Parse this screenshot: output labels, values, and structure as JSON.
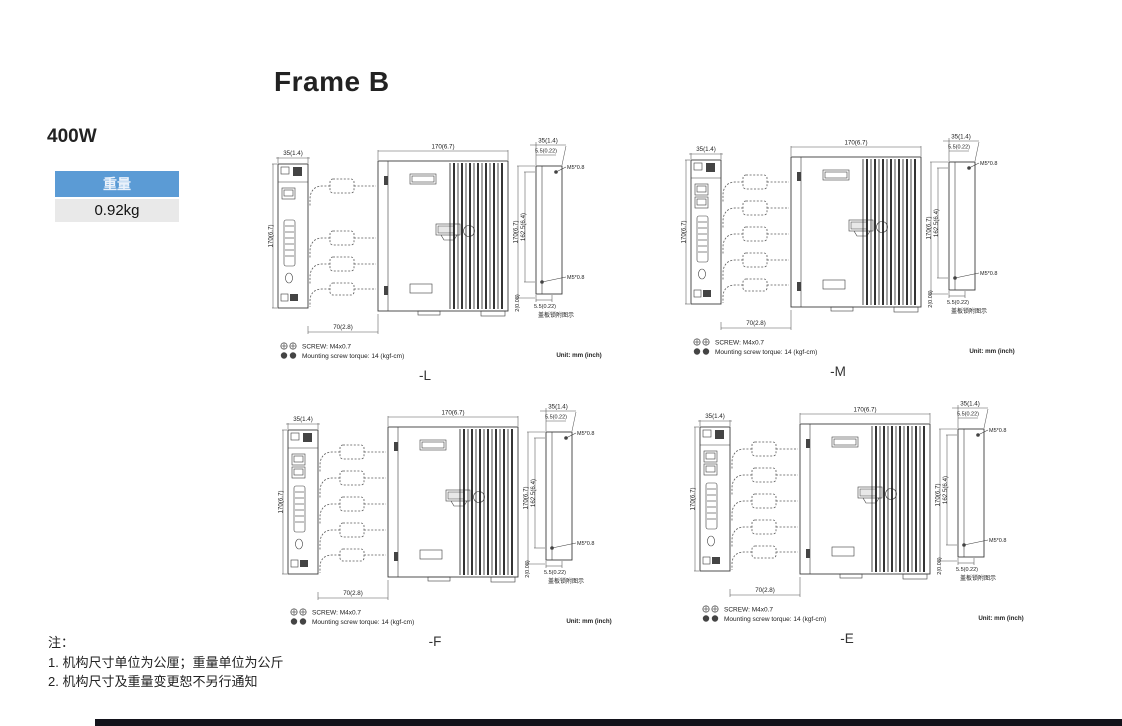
{
  "page": {
    "title": "Frame B",
    "power_rating": "400W",
    "weight_table": {
      "header": "重量",
      "value": "0.92kg"
    },
    "notes": {
      "label": "注：",
      "items": [
        "1. 机构尺寸单位为公厘；重量单位为公斤",
        "2. 机构尺寸及重量变更恕不另行通知"
      ]
    }
  },
  "dims": {
    "front_width": "35(1.4)",
    "front_height": "170(6.7)",
    "side_depth": "170(6.7)",
    "cable_clearance": "70(2.8)",
    "rear_width": "35(1.4)",
    "rear_top_offset": "5.5(0.22)",
    "rear_height": "170(6.7)",
    "mounting_pitch": "162.5(6.4)",
    "rear_bottom_gap": "2(0.08)",
    "rear_bottom_offset": "5.5(0.22)",
    "mounting_screw": "M5*0.8",
    "rear_caption": "盖板锁附图示",
    "screw_spec": "SCREW: M4x0.7",
    "torque_spec": "Mounting screw torque: 14 (kgf-cm)",
    "unit_label": "Unit: mm (inch)"
  },
  "drawings": [
    {
      "variant": "-L"
    },
    {
      "variant": "-M"
    },
    {
      "variant": "-F"
    },
    {
      "variant": "-E"
    }
  ]
}
